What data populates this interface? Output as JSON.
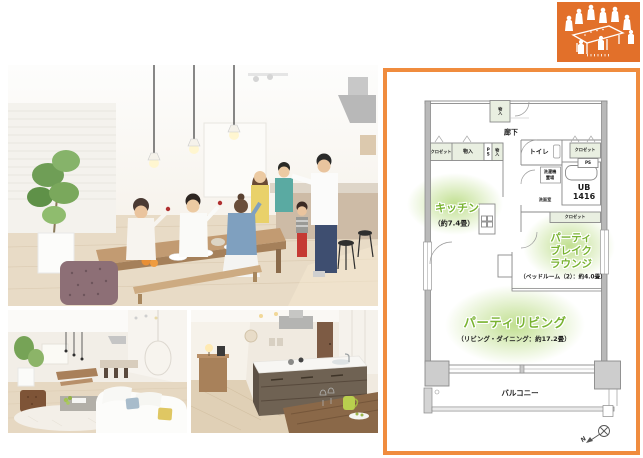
{
  "page": {
    "background": "#ffffff"
  },
  "logo": {
    "bg_color": "#e2702a",
    "icon": "party-people-around-table-pictogram"
  },
  "photos": {
    "main": "dining-party-photo",
    "living": "living-room-photo",
    "kitchen": "island-kitchen-photo"
  },
  "floorplan": {
    "border_color": "#f08c3e",
    "accent_green": "#79b331",
    "labels": {
      "hallway": "廊下",
      "storage_top": "物入",
      "closet_left": "クロゼット",
      "storage_1": "物入",
      "ps_1": "PS",
      "storage_2": "物入",
      "toilet": "トイレ",
      "closet_right": "クロゼット",
      "ps_2": "PS",
      "laundry_line1": "洗濯機",
      "laundry_line2": "置場",
      "washroom": "洗面室",
      "bath_line1": "UB",
      "bath_line2": "1416",
      "closet_bedroom": "クロゼット",
      "kitchen_name": "キッチン",
      "kitchen_size": "（約7.4畳）",
      "lounge_line1": "パーティ",
      "lounge_line2": "ブレイク",
      "lounge_line3": "ラウンジ",
      "lounge_size": "（ベッドルーム（2）：約4.0畳）",
      "living_name": "パーティリビング",
      "living_size": "（リビング・ダイニング：約17.2畳）",
      "balcony": "バルコニー",
      "compass_north": "N"
    }
  }
}
